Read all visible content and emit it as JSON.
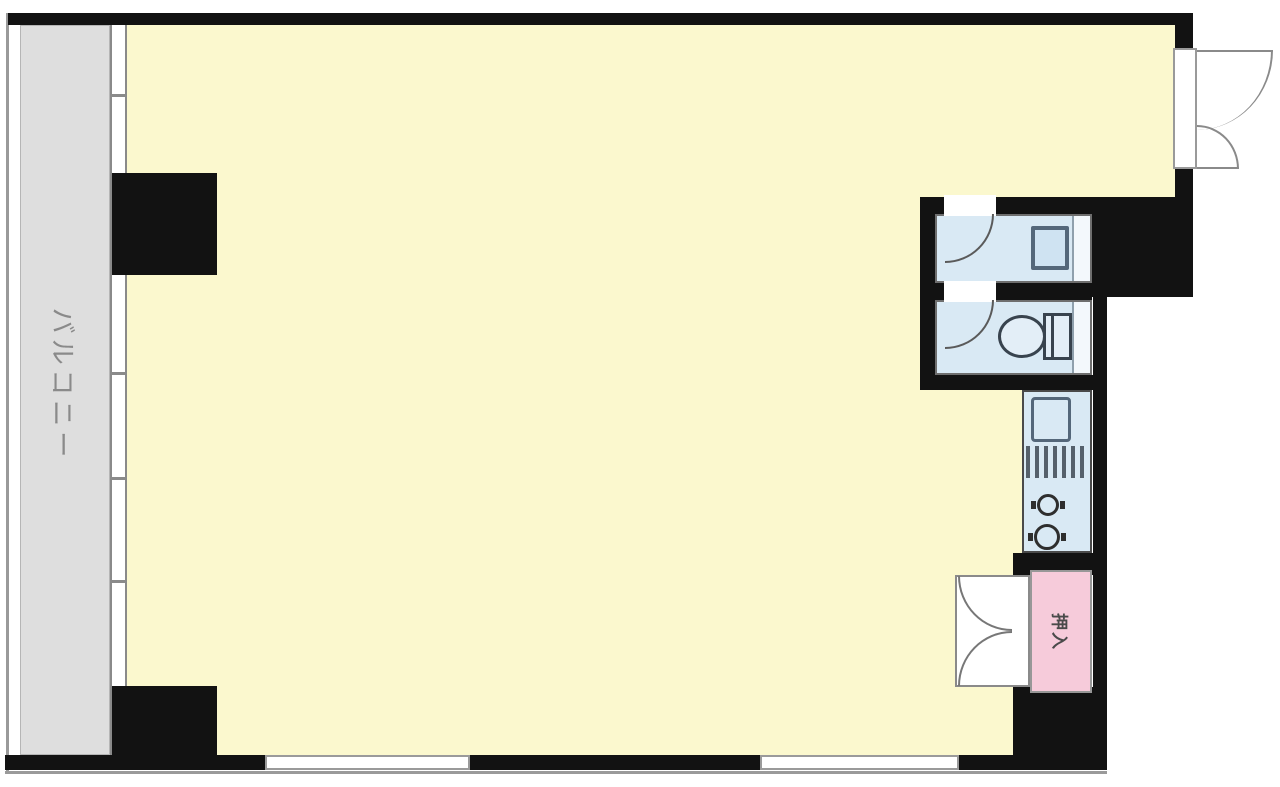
{
  "floor_plan": {
    "labels": {
      "balcony": "バルコニー",
      "closet": "押入"
    },
    "colors": {
      "main_room_fill": "#FBF8CE",
      "balcony_fill": "#DEDEDE",
      "wet_area_fill": "#D9E9F4",
      "closet_fill": "#F6CBDA",
      "wall": "#121212",
      "door_line": "#8a8a8a",
      "fixture_line": "#54677a"
    },
    "icons": [
      "washbasin-icon",
      "toilet-icon",
      "kitchen-sink-icon",
      "grill-icon",
      "stove-burner-icon",
      "door-swing-arc-icon",
      "window-icon"
    ]
  }
}
